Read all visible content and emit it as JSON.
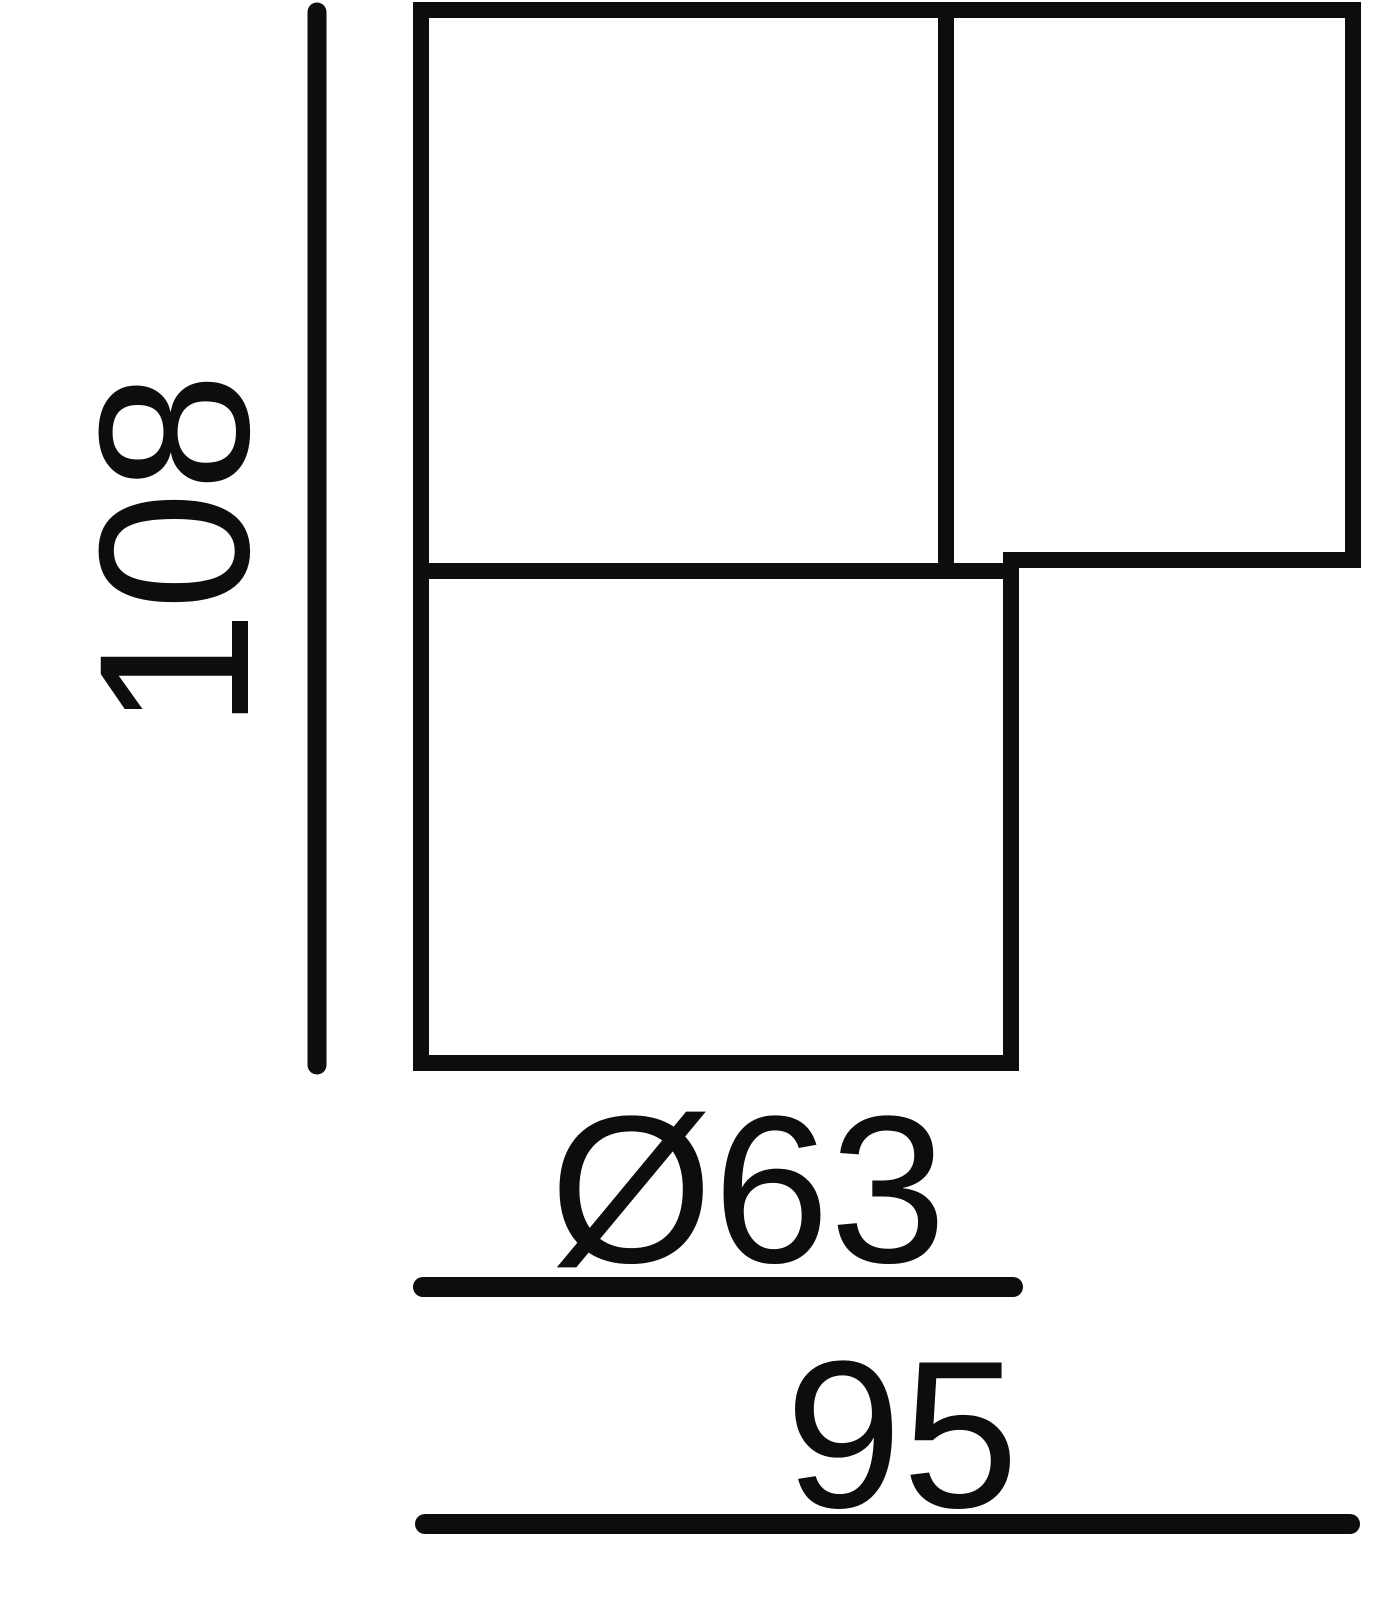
{
  "drawing": {
    "kind": "technical-dimension-drawing",
    "line_color": "#0d0d0d",
    "background_color": "#ffffff",
    "labels": {
      "height": "108",
      "diameter": "Ø63",
      "width": "95"
    },
    "values": {
      "height": 108,
      "diameter": 63,
      "width": 95
    }
  }
}
